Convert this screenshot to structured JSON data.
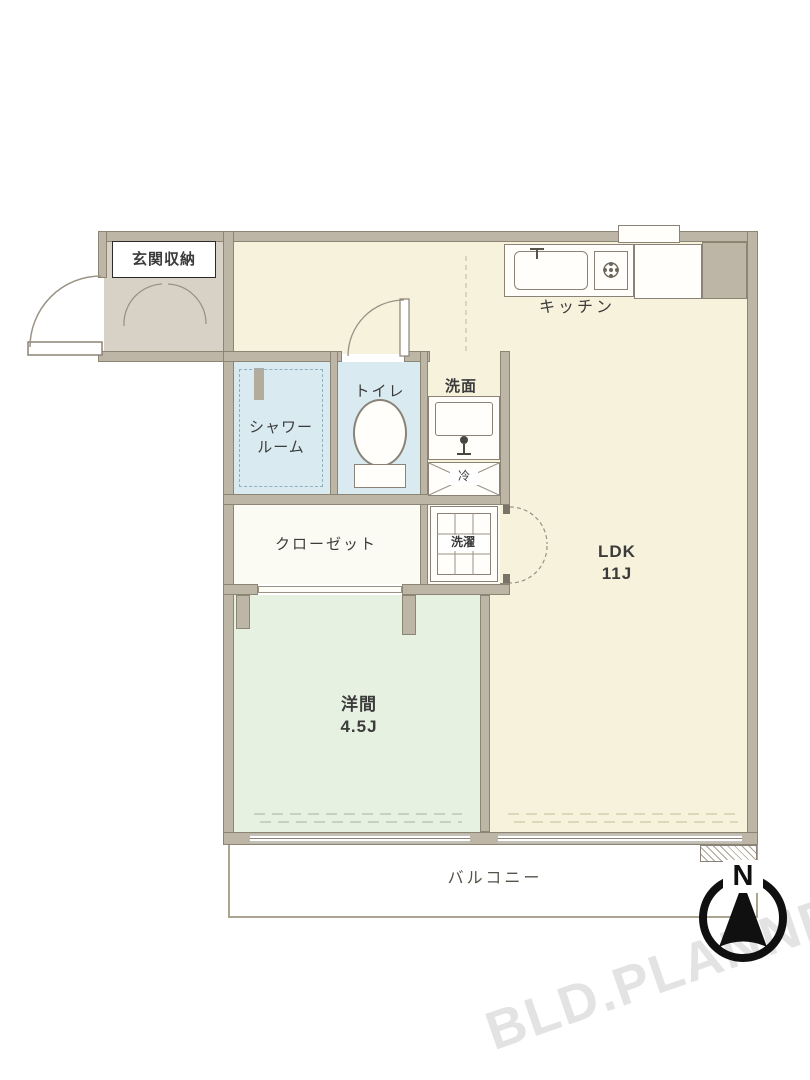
{
  "floorplan": {
    "rooms": {
      "entrance_storage": {
        "label": "玄関収納"
      },
      "kitchen": {
        "label": "キッチン"
      },
      "shower_room": {
        "label_line1": "シャワー",
        "label_line2": "ルーム"
      },
      "toilet": {
        "label": "トイレ"
      },
      "washbasin": {
        "label": "洗面"
      },
      "closet": {
        "label": "クローゼット"
      },
      "laundry": {
        "label": "洗濯"
      },
      "refrigerator": {
        "label": "冷"
      },
      "ldk": {
        "label": "LDK",
        "size": "11J"
      },
      "western_room": {
        "label": "洋間",
        "size": "4.5J"
      },
      "balcony": {
        "label": "バルコニー"
      }
    },
    "compass": {
      "north_label": "N"
    },
    "watermark": {
      "text": "BLD.PLANNER"
    },
    "colors": {
      "wall": "#bdb5a6",
      "floor_main": "#f7f2dc",
      "floor_entrance": "#d8d2c6",
      "floor_wet": "#d9ebf1",
      "floor_western": "#e7f1e1",
      "floor_service": "#fbfbf4",
      "compass": "#101010",
      "watermark_gray": "#e3e3e3"
    }
  }
}
